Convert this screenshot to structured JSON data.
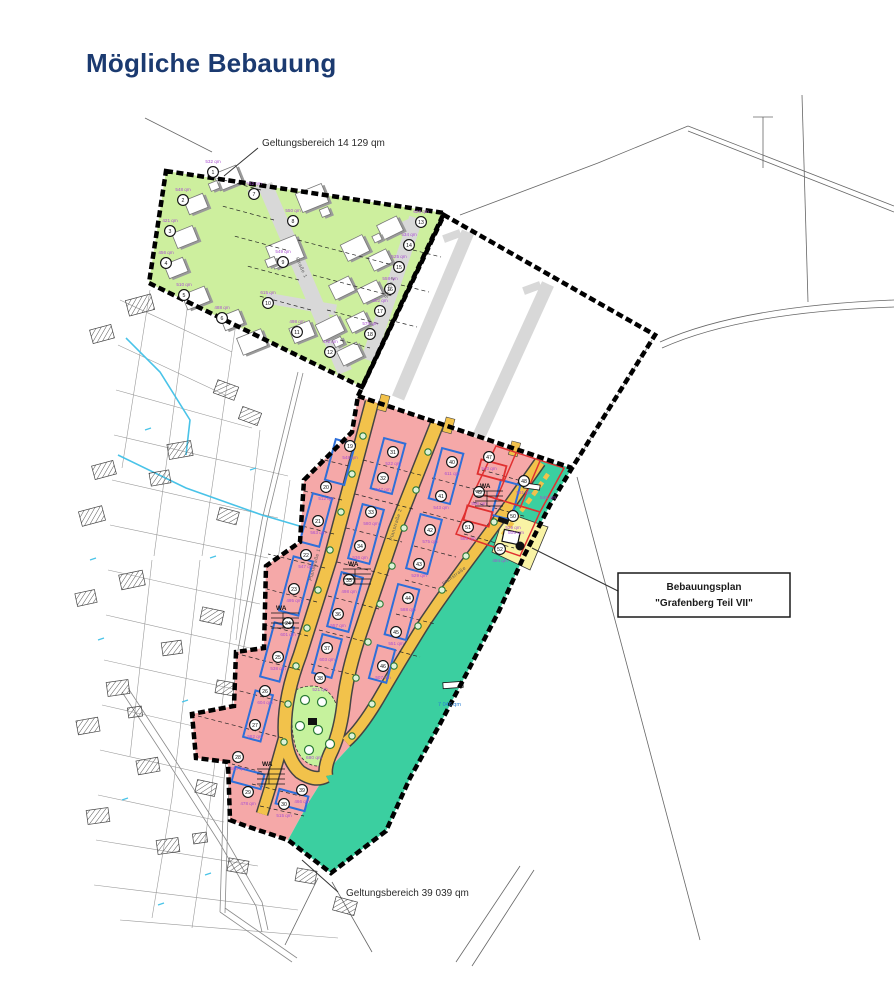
{
  "title": "Mögliche Bebauung",
  "annotations": {
    "top_area": "Geltungsbereich 14 129 qm",
    "bottom_area": "Geltungsbereich 39 039 qm",
    "plan_box_line1": "Bebauungsplan",
    "plan_box_line2": "\"Grafenberg Teil VII\"",
    "green_space_area": "7 046 qm",
    "utility_area": "505 qm",
    "teal_plot_area": "548 qm",
    "playground_area": "680 qm"
  },
  "colors": {
    "green_zone": "#cdef9e",
    "pink_zone": "#f5a8a8",
    "teal_green": "#3bcfa0",
    "road_yellow": "#f2c24b",
    "road_gray": "#d8d8d8",
    "playground": "#c6f29d",
    "utility_yellow": "#f9f3a5",
    "window_blue": "#2e6fd9",
    "change_red": "#e03030",
    "area_text_purple": "#a94fd1",
    "stream_cyan": "#49c3e8",
    "title_navy": "#1b3a70"
  },
  "streets": [
    {
      "name": "Straße 1",
      "x": 300,
      "y": 268,
      "rot": 66
    },
    {
      "name": "Straße 2",
      "x": 391,
      "y": 288,
      "rot": -71
    },
    {
      "name": "Planstraße 1",
      "x": 316,
      "y": 565,
      "rot": -75
    },
    {
      "name": "Planstraße 2",
      "x": 397,
      "y": 525,
      "rot": -73
    },
    {
      "name": "Planstraße",
      "x": 455,
      "y": 577,
      "rot": -37
    }
  ],
  "wa_markers": [
    {
      "label": "WA",
      "x": 348,
      "y": 566
    },
    {
      "label": "WA",
      "x": 276,
      "y": 610
    },
    {
      "label": "WA",
      "x": 480,
      "y": 488
    },
    {
      "label": "WA",
      "x": 262,
      "y": 766
    }
  ],
  "plots_green": [
    {
      "n": "1",
      "x": 213,
      "y": 172,
      "area": "532 qm"
    },
    {
      "n": "2",
      "x": 183,
      "y": 200,
      "area": "548 qm"
    },
    {
      "n": "3",
      "x": 170,
      "y": 231,
      "area": "421 qm"
    },
    {
      "n": "4",
      "x": 166,
      "y": 263,
      "area": "456 qm"
    },
    {
      "n": "5",
      "x": 184,
      "y": 295,
      "area": "510 qm"
    },
    {
      "n": "6",
      "x": 222,
      "y": 318,
      "area": "488 qm"
    },
    {
      "n": "7",
      "x": 254,
      "y": 194,
      "area": "562 qm"
    },
    {
      "n": "8",
      "x": 293,
      "y": 221,
      "area": "550 qm"
    },
    {
      "n": "9",
      "x": 283,
      "y": 262,
      "area": "549 qm"
    },
    {
      "n": "10",
      "x": 268,
      "y": 303,
      "area": "615 qm"
    },
    {
      "n": "11",
      "x": 297,
      "y": 332,
      "area": "498 qm"
    },
    {
      "n": "12",
      "x": 330,
      "y": 352,
      "area": "472 qm"
    },
    {
      "n": "13",
      "x": 421,
      "y": 222,
      "area": "628 qm"
    },
    {
      "n": "14",
      "x": 409,
      "y": 245,
      "area": "534 qm"
    },
    {
      "n": "15",
      "x": 399,
      "y": 267,
      "area": "525 qm"
    },
    {
      "n": "16",
      "x": 390,
      "y": 289,
      "area": "558 qm"
    },
    {
      "n": "17",
      "x": 380,
      "y": 311,
      "area": "602 qm"
    },
    {
      "n": "18",
      "x": 370,
      "y": 334,
      "area": "575 qm"
    }
  ],
  "plots_pink": [
    {
      "n": "19",
      "x": 350,
      "y": 446,
      "area": "548 qm"
    },
    {
      "n": "20",
      "x": 326,
      "y": 487,
      "area": "512 qm"
    },
    {
      "n": "21",
      "x": 318,
      "y": 521,
      "area": "563 qm"
    },
    {
      "n": "22",
      "x": 306,
      "y": 555,
      "area": "547 qm"
    },
    {
      "n": "23",
      "x": 294,
      "y": 589,
      "area": "495 qm"
    },
    {
      "n": "24",
      "x": 288,
      "y": 623,
      "area": "601 qm"
    },
    {
      "n": "25",
      "x": 278,
      "y": 657,
      "area": "538 qm"
    },
    {
      "n": "26",
      "x": 265,
      "y": 691,
      "area": "604 qm"
    },
    {
      "n": "27",
      "x": 255,
      "y": 725,
      "area": "582 qm"
    },
    {
      "n": "28",
      "x": 238,
      "y": 757,
      "area": "560 qm"
    },
    {
      "n": "29",
      "x": 248,
      "y": 792,
      "area": "478 qm"
    },
    {
      "n": "30",
      "x": 284,
      "y": 804,
      "area": "515 qm"
    },
    {
      "n": "31",
      "x": 393,
      "y": 452,
      "area": "522 qm"
    },
    {
      "n": "32",
      "x": 383,
      "y": 478,
      "area": "547 qm"
    },
    {
      "n": "33",
      "x": 371,
      "y": 512,
      "area": "580 qm"
    },
    {
      "n": "34",
      "x": 360,
      "y": 546,
      "area": "536 qm"
    },
    {
      "n": "35",
      "x": 349,
      "y": 580,
      "area": "498 qm"
    },
    {
      "n": "36",
      "x": 338,
      "y": 614,
      "area": "557 qm"
    },
    {
      "n": "37",
      "x": 327,
      "y": 648,
      "area": "603 qm"
    },
    {
      "n": "38",
      "x": 320,
      "y": 678,
      "area": "521 qm"
    },
    {
      "n": "39",
      "x": 302,
      "y": 790,
      "area": "466 qm"
    },
    {
      "n": "40",
      "x": 452,
      "y": 462,
      "area": "611 qm"
    },
    {
      "n": "41",
      "x": 441,
      "y": 496,
      "area": "543 qm"
    },
    {
      "n": "42",
      "x": 430,
      "y": 530,
      "area": "575 qm"
    },
    {
      "n": "43",
      "x": 419,
      "y": 564,
      "area": "529 qm"
    },
    {
      "n": "44",
      "x": 408,
      "y": 598,
      "area": "588 qm"
    },
    {
      "n": "45",
      "x": 396,
      "y": 632,
      "area": "551 qm"
    },
    {
      "n": "46",
      "x": 383,
      "y": 666,
      "area": "507 qm"
    },
    {
      "n": "47",
      "x": 489,
      "y": 457,
      "area": "540 qm"
    },
    {
      "n": "48",
      "x": 524,
      "y": 481,
      "area": "531 qm"
    },
    {
      "n": "49",
      "x": 479,
      "y": 492,
      "area": "566 qm"
    },
    {
      "n": "50",
      "x": 513,
      "y": 516,
      "area": "529 qm"
    },
    {
      "n": "51",
      "x": 468,
      "y": 527,
      "area": "585 qm"
    },
    {
      "n": "52",
      "x": 500,
      "y": 549,
      "area": "494 qm"
    }
  ]
}
